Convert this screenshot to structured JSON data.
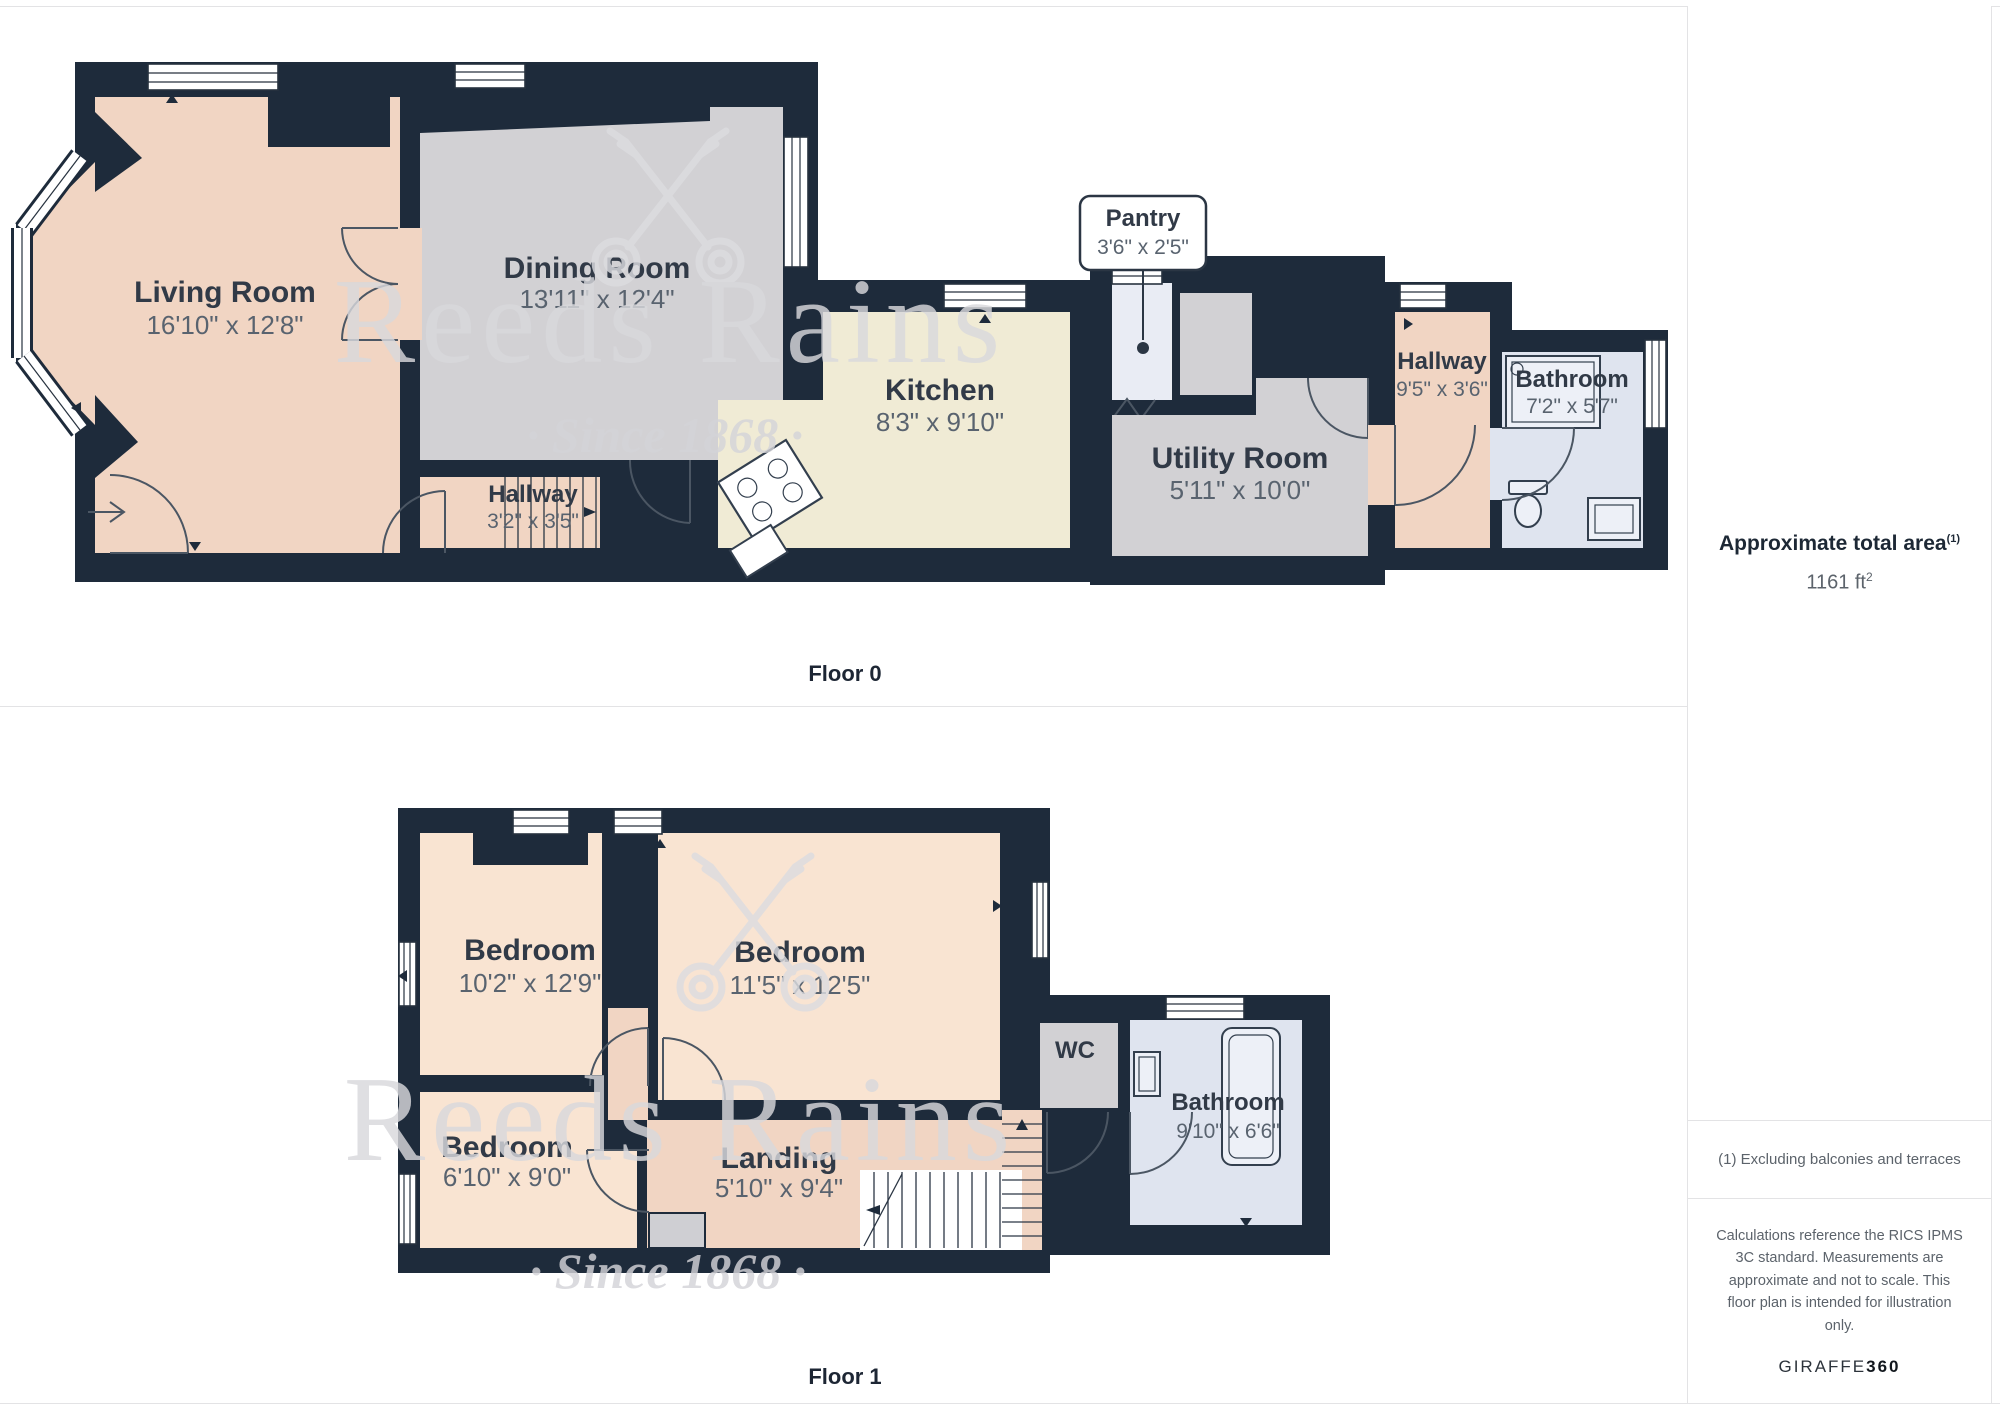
{
  "watermark": {
    "brand": "Reeds Rains",
    "tagline": "· Since 1868 ·"
  },
  "floor0": {
    "label": "Floor 0",
    "rooms": {
      "living": {
        "name": "Living Room",
        "dims": "16'10\" x 12'8\""
      },
      "dining": {
        "name": "Dining Room",
        "dims": "13'11\" x 12'4\""
      },
      "hallway": {
        "name": "Hallway",
        "dims": "3'2\" x 3'5\""
      },
      "kitchen": {
        "name": "Kitchen",
        "dims": "8'3\" x 9'10\""
      },
      "pantry": {
        "name": "Pantry",
        "dims": "3'6\" x 2'5\""
      },
      "utility": {
        "name": "Utility Room",
        "dims": "5'11\" x 10'0\""
      },
      "hallway2": {
        "name": "Hallway",
        "dims": "9'5\" x 3'6\""
      },
      "bathroom": {
        "name": "Bathroom",
        "dims": "7'2\" x 5'7\""
      }
    }
  },
  "floor1": {
    "label": "Floor 1",
    "rooms": {
      "bedroom1": {
        "name": "Bedroom",
        "dims": "10'2\" x 12'9\""
      },
      "bedroom2": {
        "name": "Bedroom",
        "dims": "11'5\" x 12'5\""
      },
      "bedroom3": {
        "name": "Bedroom",
        "dims": "6'10\" x 9'0\""
      },
      "landing": {
        "name": "Landing",
        "dims": "5'10\" x 9'4\""
      },
      "wc": {
        "name": "WC"
      },
      "bathroom": {
        "name": "Bathroom",
        "dims": "9'10\" x 6'6\""
      }
    }
  },
  "sidebar": {
    "area_title": "Approximate total area",
    "area_marker": "(1)",
    "area_value": "1161 ft",
    "area_sup": "2",
    "footnote": "(1) Excluding balconies and terraces",
    "disclaimer": "Calculations reference the RICS IPMS 3C standard. Measurements are approximate and not to scale. This floor plan is intended for illustration only.",
    "brand_name": "GIRAFFE",
    "brand_suffix": "360"
  },
  "colors": {
    "wall": "#1e2b3b",
    "room_peach": "#f1d5c3",
    "room_peach_light": "#f9e4d2",
    "room_gray": "#d2d1d4",
    "room_cream": "#f0ebd5",
    "room_pantry": "#e9ecf4",
    "room_bath": "#dfe4ef"
  }
}
